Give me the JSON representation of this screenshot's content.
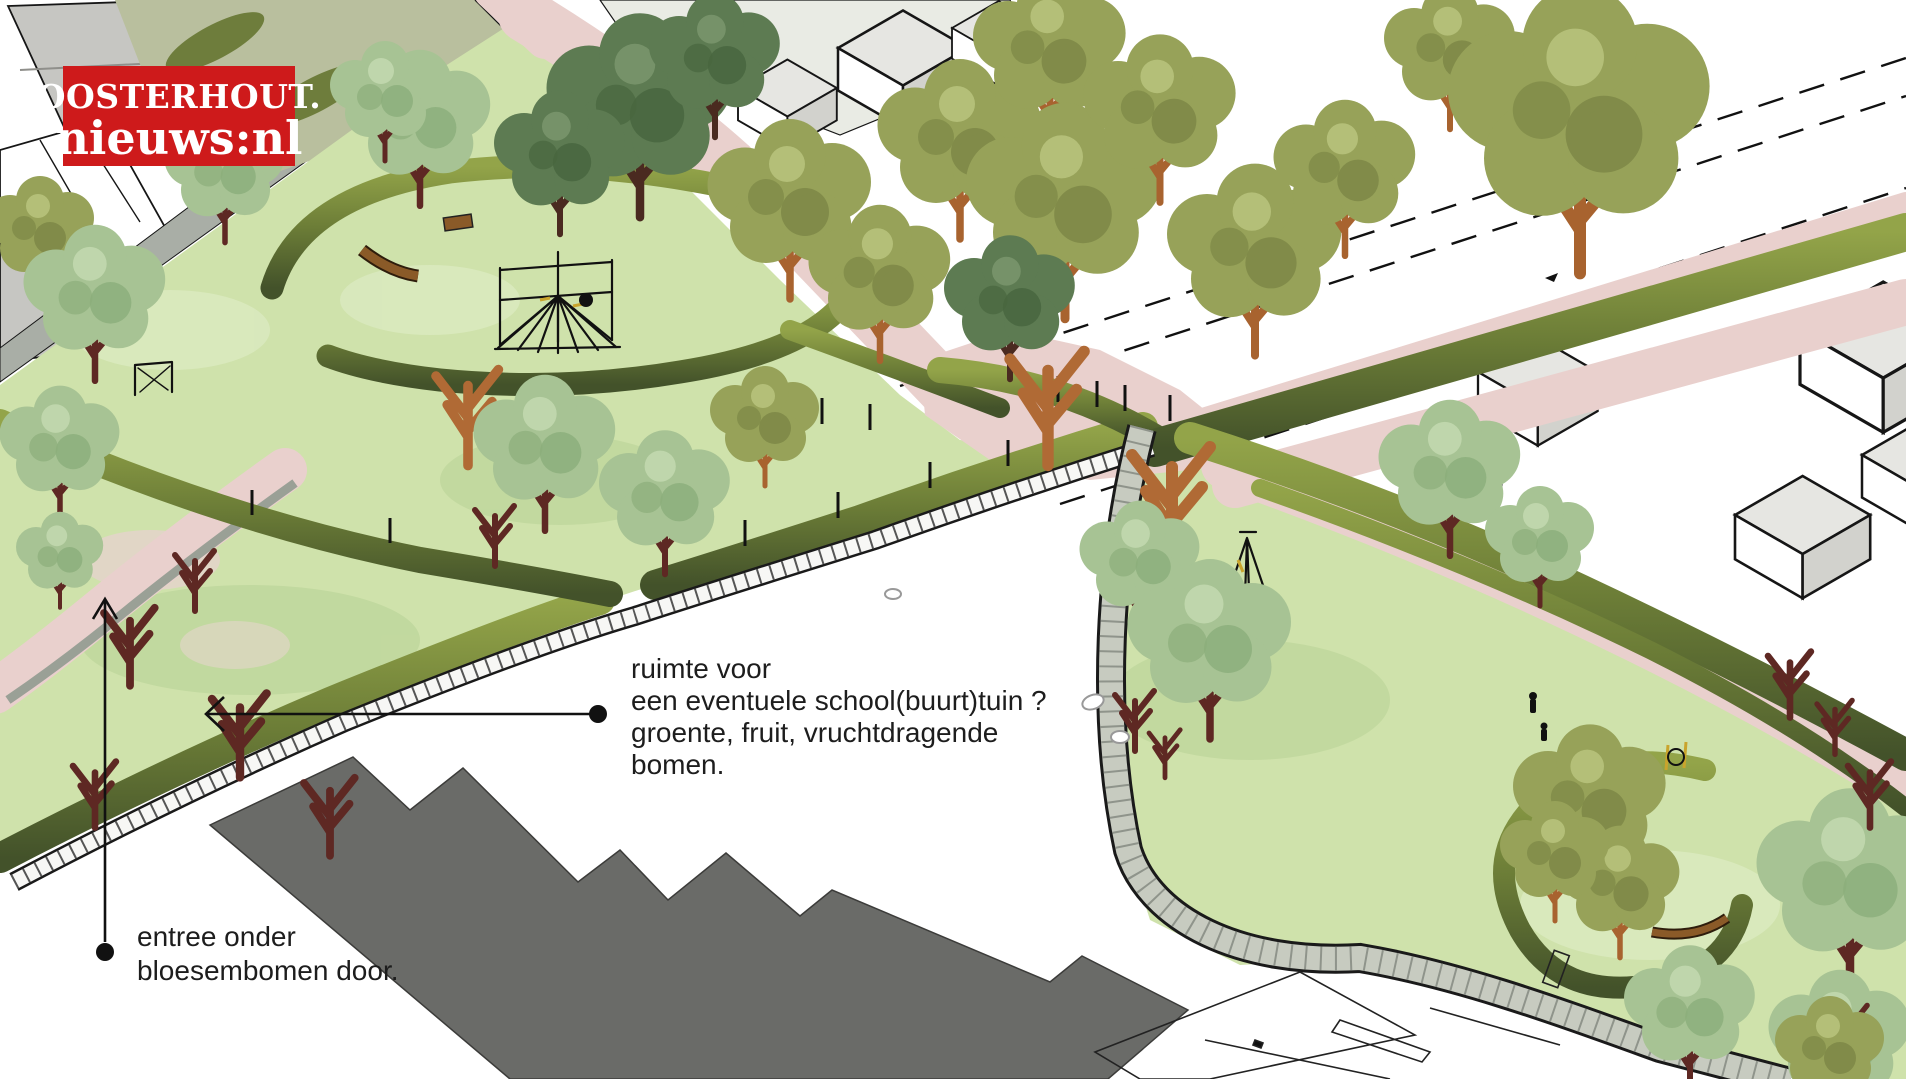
{
  "page": {
    "title": "Parkontwerp rond school - isometrische plantekening"
  },
  "logo": {
    "line1": "OOSTERHOUT.",
    "line2": "nieuws:nl",
    "background": "#ce1a1b",
    "text_color": "#ffffff"
  },
  "annotations": {
    "garden_note": {
      "lines": [
        "ruimte voor",
        "een eventuele school(buurt)tuin ?",
        "groente, fruit, vruchtdragende",
        "bomen."
      ]
    },
    "entrance_note": {
      "lines": [
        "entree onder",
        "bloesembomen door."
      ]
    }
  },
  "palette": {
    "lawn": "#cfe2ab",
    "lawn_shade": "#bdd69b",
    "lawn_light": "#dcebc2",
    "path_pink": "#e9d0cd",
    "hedge_light": "#93a449",
    "hedge_mid": "#6c7d37",
    "hedge_dark": "#43522a",
    "tree_sage": "#a7c394",
    "tree_olive": "#97a259",
    "tree_dark_green": "#5d7b52",
    "trunk_orange": "#b06a35",
    "trunk_maroon": "#5e2823",
    "school_grey": "#6a6b68",
    "roof_grey": "#c6c6c2",
    "wall_grey": "#c7cbc0",
    "road_white": "#ffffff",
    "outline_black": "#1a1a1a"
  }
}
